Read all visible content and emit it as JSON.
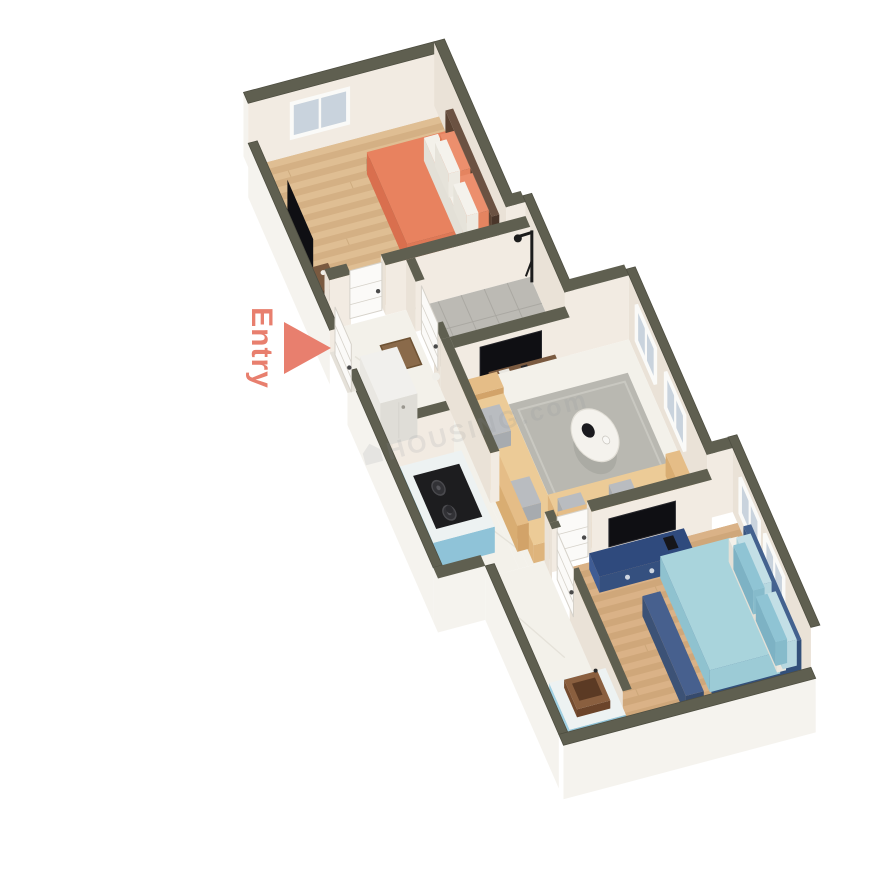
{
  "scene": {
    "type": "3d-floor-plan-render",
    "background": "#ffffff"
  },
  "labels": {
    "entry": "Entry",
    "watermark": "HOUSING.com"
  },
  "colors": {
    "cap": "#5f5f50",
    "capEdge": "#4e4e41",
    "wallFaceS": "#f2ebe2",
    "wallFaceW": "#eae2d7",
    "wallOuter": "#f5f3ee",
    "door": "#fbfaf8",
    "doorEdge": "#d6d2ca",
    "glass": "#c9d3dd",
    "glassFrame": "#fafaf8",
    "woodBase": "#d4b084",
    "woodLight": "#dfbe93",
    "woodDark": "#c3a071",
    "wood2Base": "#cfa77a",
    "wood2Light": "#dab287",
    "marble": "#f3f1ea",
    "marbleVein": "#e2dfd6",
    "tile": "#bcbab4",
    "tileLine": "#a9a7a1",
    "bedOrange": "#e8825f",
    "bedOrangeW": "#d96f4e",
    "bedOrangeS": "#de7856",
    "pillowOrange": "#ec8f6d",
    "bedWhite": "#f3f1ea",
    "brown": "#6b5242",
    "brownW": "#5a4232",
    "brownS": "#4a362a",
    "shelfWood": "#7a5a40",
    "shelfWoodW": "#684a32",
    "shelfWoodS": "#5f422c",
    "tv": "#0f0f13",
    "blueFrame": "#44628f",
    "blueFrameW": "#3a5680",
    "blueFrameS": "#33507a",
    "bedBlue": "#a9d4dc",
    "bedBlueW": "#8fc2cf",
    "bedBlueS": "#9ccbd6",
    "pillowBlue": "#8fc4d4",
    "pillowPale": "#c3dfe6",
    "benchBlue": "#47608e",
    "consoleBlue": "#3f5c94",
    "consoleBlueTop": "#2f4a7d",
    "sofa": "#eccb97",
    "sofaSide": "#deb47c",
    "sofaBack": "#e5bd87",
    "sofaBackW": "#d9ad72",
    "sofaBackS": "#d2a369",
    "pillowGray": "#b9bcc0",
    "pillowGrayS": "#a7abaf",
    "rug": "#b9b8b1",
    "rugLine": "#c9c8c1",
    "tableTop": "#f4f2ed",
    "counterTop": "#edf2f2",
    "counterBlue": "#9fcfe2",
    "counterBlueS": "#8fc3d8",
    "stove": "#1d1d1f",
    "fridge": "#f1f0ed",
    "fridgeW": "#e9e7e2",
    "fridgeS": "#dfddd7",
    "sinkBrown": "#8a5f3f",
    "sinkBrownW": "#744c30",
    "sinkBrownS": "#6b442a",
    "sinkBowl": "#5b3a24",
    "white": "#f6f5f1",
    "accent": "#e87f6e",
    "watermark": "#8a8f96"
  }
}
